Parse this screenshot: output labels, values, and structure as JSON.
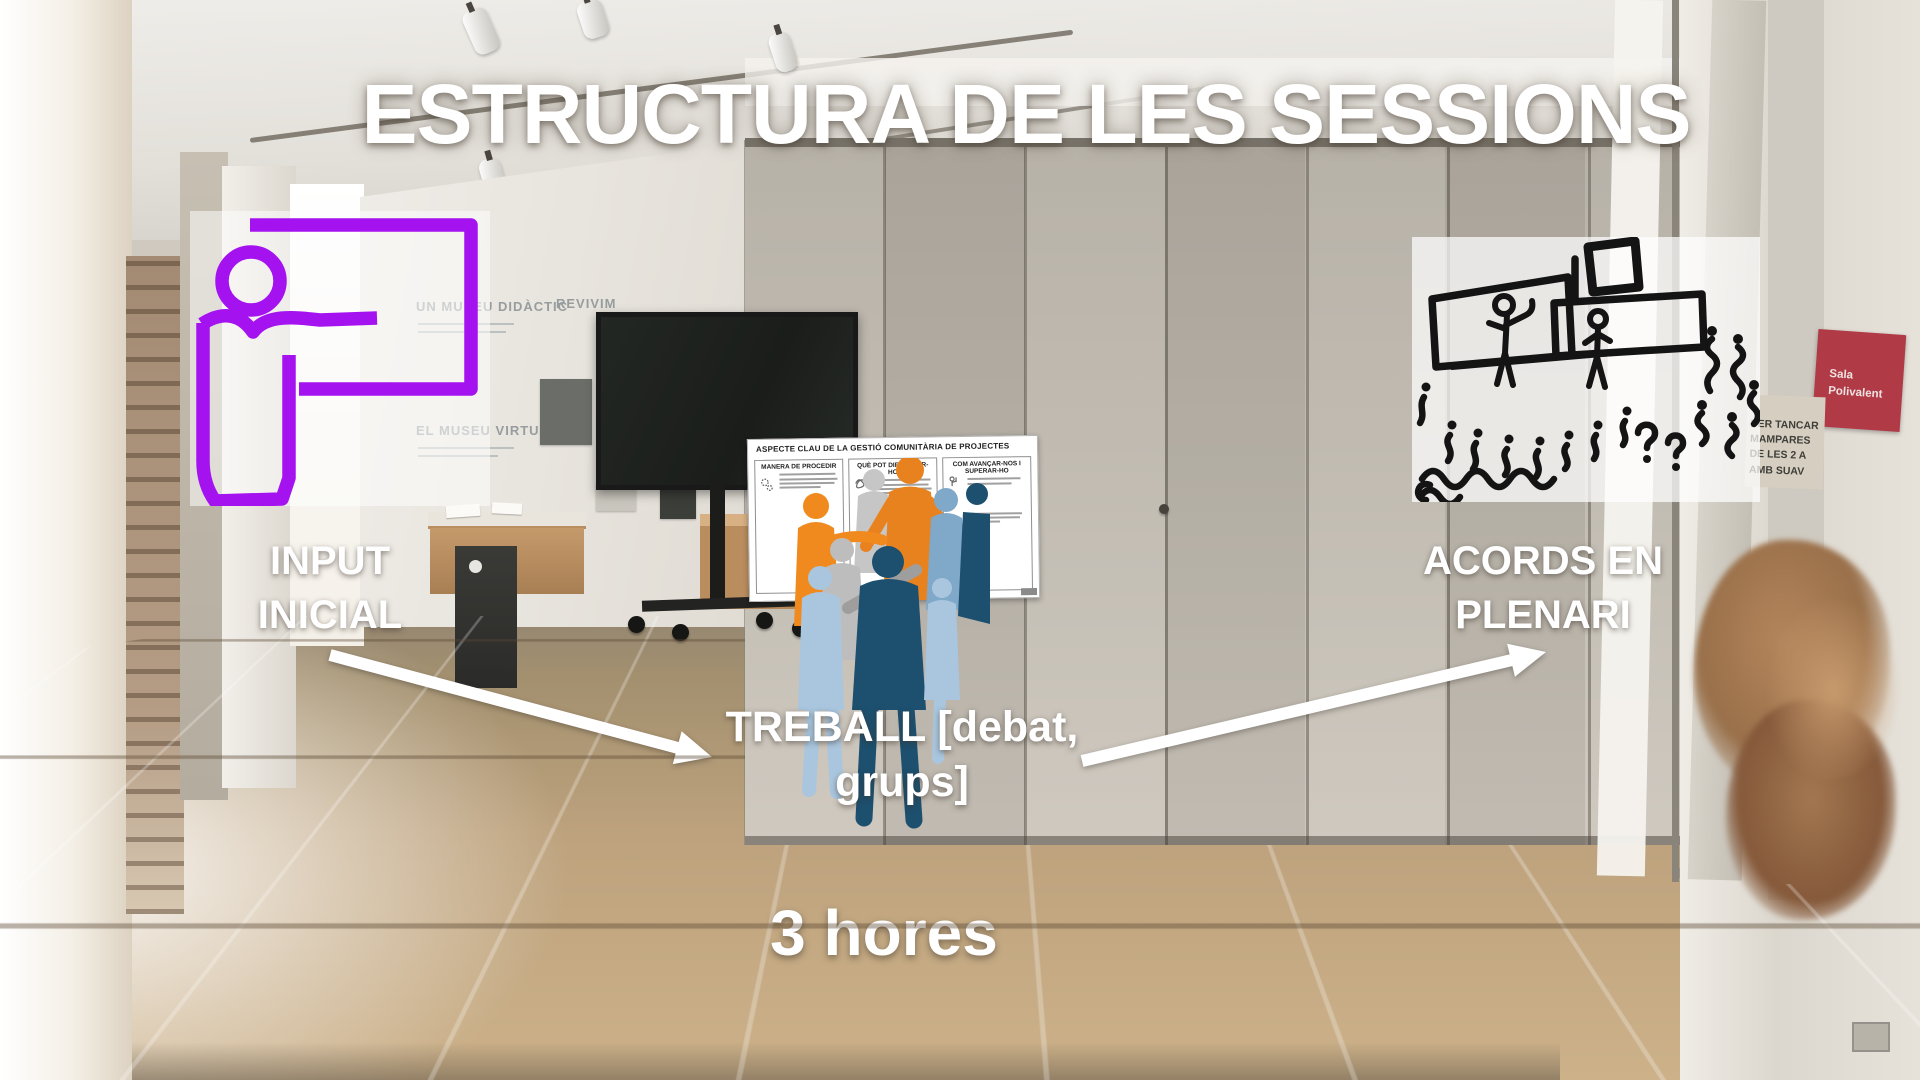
{
  "slide": {
    "title": "ESTRUCTURA DE LES SESSIONS",
    "duration_label": "3 hores",
    "steps": {
      "input": {
        "lines": [
          "INPUT",
          "INICIAL"
        ]
      },
      "treball": {
        "lines": [
          "TREBALL [debat,",
          "grups]"
        ]
      },
      "acords": {
        "lines": [
          "ACORDS EN",
          "PLENARI"
        ]
      }
    }
  },
  "worksheet": {
    "title": "ASPECTE CLAU DE LA GESTIÓ COMUNITÀRIA DE PROJECTES",
    "columns": [
      {
        "heading": "MANERA DE PROCEDIR"
      },
      {
        "heading": "QUÈ POT DIFICULTAR-HO"
      },
      {
        "heading": "COM AVANÇAR-NOS I SUPERAR-HO"
      }
    ]
  },
  "room": {
    "exhibit": {
      "heading_1": "UN MUSEU DIDÀCTIC",
      "heading_2": "REVIVIM",
      "heading_3": "EL MUSEU VIRTUAL"
    },
    "red_sign": {
      "lines": [
        "Sala",
        "Polivalent"
      ]
    },
    "paper_sign": {
      "lines": [
        "PER TANCAR",
        "MAMPARES",
        "DE LES 2 A",
        "AMB SUAV"
      ]
    }
  },
  "colors": {
    "icon_purple": "#A512F0",
    "silhouette_orange": "#E8821E",
    "silhouette_lightblue": "#A9C6DE",
    "silhouette_navy": "#1D4F6E",
    "silhouette_gray": "#C2C2C2",
    "sign_red": "#B13A47",
    "arrow_white": "#FFFFFF"
  }
}
